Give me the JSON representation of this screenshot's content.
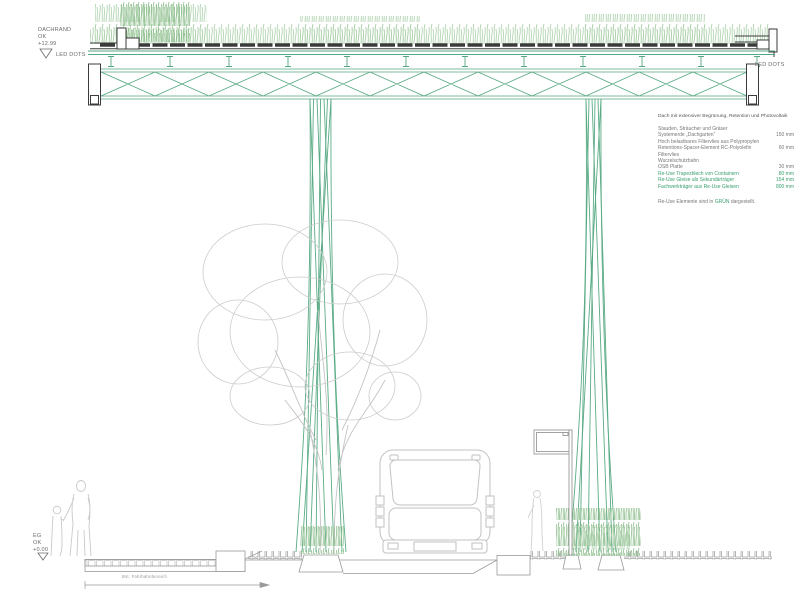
{
  "annotations": {
    "dachrand": "DACHRAND\nOK\n+12.99",
    "led_dots_left": "LED DOTS",
    "led_dots_right": "LED DOTS",
    "eg": "EG\nOK\n+0.00",
    "platform_label": "Bst. Fahrbahnbereich"
  },
  "legend": {
    "title": "Dach mit extensiver Begrünung, Retention und Photovoltaik",
    "rows": [
      {
        "label": "Stauden, Sträucher und Gräser",
        "value": "",
        "green": false
      },
      {
        "label": "Systemerde „Dachgarten“",
        "value": "150 mm",
        "green": false
      },
      {
        "label": "Hoch belastbares Filtervlies aus Polypropylen",
        "value": "",
        "green": false
      },
      {
        "label": "Retentions-Spacer-Element RC-Polyolefin",
        "value": "60 mm",
        "green": false
      },
      {
        "label": "Filtervlies",
        "value": "",
        "green": false
      },
      {
        "label": "Wurzelschutzbahn",
        "value": "",
        "green": false
      },
      {
        "label": "OSB Platte",
        "value": "30 mm",
        "green": false
      },
      {
        "label": "Re-Use Trapezblech von Containern",
        "value": "80 mm",
        "green": true
      },
      {
        "label": "Re-Use Gleise als Sekundärträger",
        "value": "154 mm",
        "green": true
      },
      {
        "label": "Fachwerkträger aus Re-Use Gleisen",
        "value": "800 mm",
        "green": true
      }
    ],
    "footer_pre": "Re-Use Elemente sind in ",
    "footer_highlight": "GRÜN",
    "footer_post": " dargestellt."
  },
  "colors": {
    "reuse_green": "#3aa06e",
    "structure_green": "#54a781",
    "vegetation_green": "#a9cfa9",
    "vegetation_dark_green": "#8fbf8f",
    "roof_dark": "#3b3b3b",
    "annotation_gray": "#6b6b6b",
    "entourage_gray": "#c9c9c9",
    "ground_gray": "#9a9a9a"
  }
}
